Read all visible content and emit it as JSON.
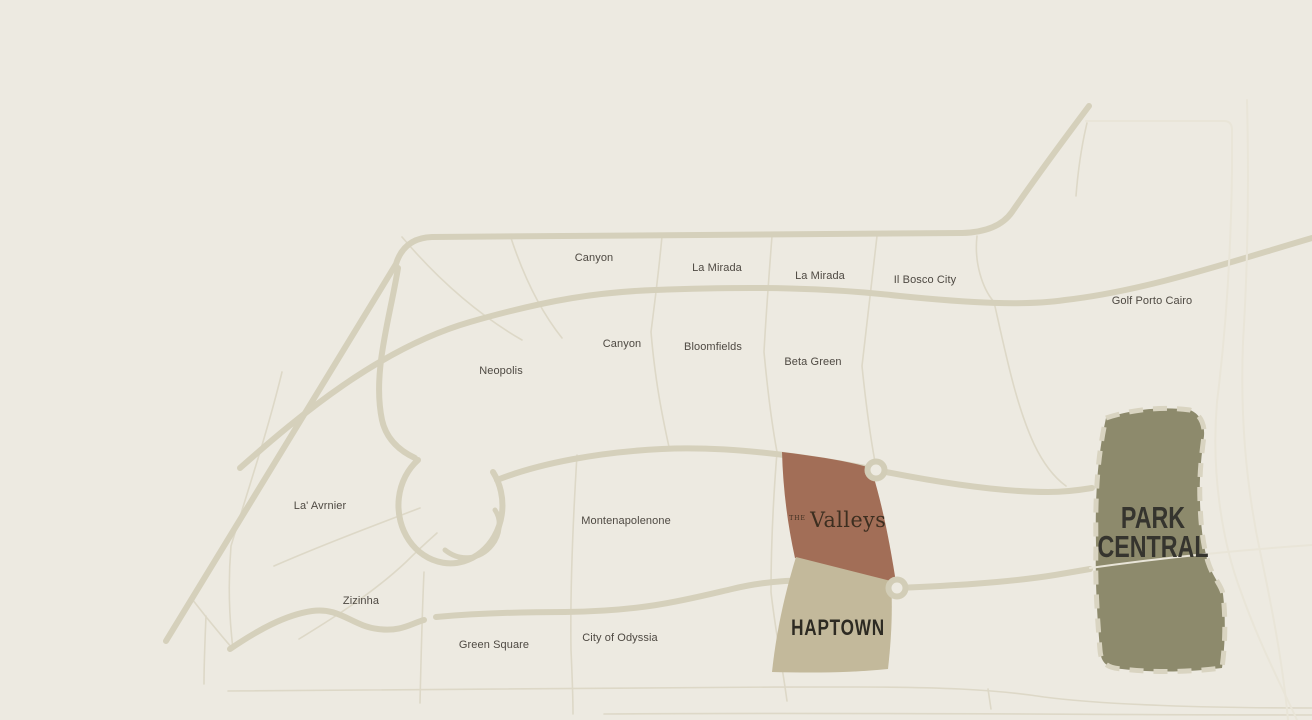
{
  "map": {
    "districts": [
      {
        "id": "canyon-north",
        "label": "Canyon"
      },
      {
        "id": "la-mirada-west",
        "label": "La Mirada"
      },
      {
        "id": "la-mirada-east",
        "label": "La Mirada"
      },
      {
        "id": "il-bosco-city",
        "label": "Il Bosco City"
      },
      {
        "id": "golf-porto-cairo",
        "label": "Golf Porto Cairo"
      },
      {
        "id": "canyon-south",
        "label": "Canyon"
      },
      {
        "id": "bloomfields",
        "label": "Bloomfields"
      },
      {
        "id": "beta-green",
        "label": "Beta Green"
      },
      {
        "id": "neopolis",
        "label": "Neopolis"
      },
      {
        "id": "la-avrnier",
        "label": "La' Avrnier"
      },
      {
        "id": "montenapolenone",
        "label": "Montenapolenone"
      },
      {
        "id": "zizinha",
        "label": "Zizinha"
      },
      {
        "id": "green-square",
        "label": "Green Square"
      },
      {
        "id": "city-of-odyssia",
        "label": "City of Odyssia"
      }
    ],
    "developments": {
      "the_valleys": {
        "prefix": "THE",
        "name": "Valleys",
        "fill": "#a26e57"
      },
      "haptown": {
        "name": "HAPTOWN",
        "fill": "#c3b99b"
      },
      "park_central": {
        "line1": "PARK",
        "line2": "CENTRAL",
        "fill": "#8d8a6c"
      }
    },
    "colors": {
      "background": "#edeae1",
      "road_major": "#d5d0bb",
      "road_minor": "#ddd8c7",
      "road_over_dev": "#e9e5d8",
      "marker_ring": "#d2cdb7",
      "label_text": "#4e4942"
    }
  }
}
